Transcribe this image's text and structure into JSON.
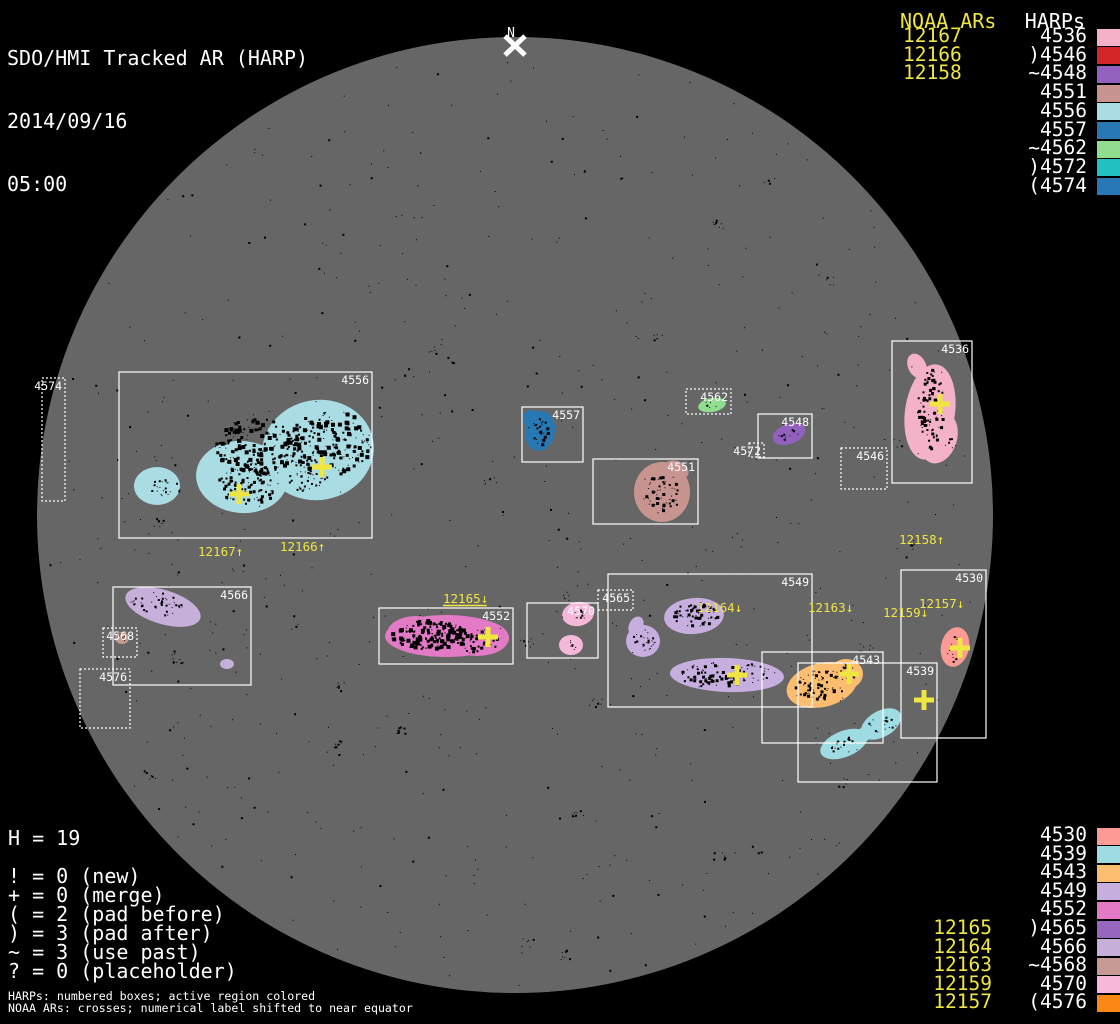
{
  "header": {
    "title": "SDO/HMI Tracked AR (HARP)",
    "date": "2014/09/16",
    "time": "05:00"
  },
  "north_marker": {
    "label": "N"
  },
  "colors": {
    "background": "#000000",
    "disk": "#666666",
    "accent_yellow": "#f0e641",
    "box_stroke": "#ffffff"
  },
  "top_right": {
    "noaa_header": "NOAA ARs",
    "noaa_numbers": [
      "12167",
      "12166",
      "12158"
    ],
    "harps_header": "HARPs",
    "harps": [
      {
        "prefix": "",
        "label": "4536",
        "color": "#f4b2c8"
      },
      {
        "prefix": ")",
        "label": "4546",
        "color": "#d32426"
      },
      {
        "prefix": "~",
        "label": "4548",
        "color": "#9161bd"
      },
      {
        "prefix": "",
        "label": "4551",
        "color": "#c79490"
      },
      {
        "prefix": "",
        "label": "4556",
        "color": "#aadce4"
      },
      {
        "prefix": "",
        "label": "4557",
        "color": "#2878b4"
      },
      {
        "prefix": "~",
        "label": "4562",
        "color": "#90dd90"
      },
      {
        "prefix": ")",
        "label": "4572",
        "color": "#20c0c0"
      },
      {
        "prefix": "(",
        "label": "4574",
        "color": "#2878b8"
      }
    ]
  },
  "bottom_right": {
    "harps": [
      {
        "prefix": "",
        "label": "4530",
        "color": "#fc9a96",
        "noaa": ""
      },
      {
        "prefix": "",
        "label": "4539",
        "color": "#9edbe2",
        "noaa": ""
      },
      {
        "prefix": "",
        "label": "4543",
        "color": "#fdbd70",
        "noaa": ""
      },
      {
        "prefix": "",
        "label": "4549",
        "color": "#c6aede",
        "noaa": ""
      },
      {
        "prefix": "",
        "label": "4552",
        "color": "#e27ac6",
        "noaa": ""
      },
      {
        "prefix": ")",
        "label": "4565",
        "color": "#9767bf",
        "noaa": "12165"
      },
      {
        "prefix": "",
        "label": "4566",
        "color": "#c6b0da",
        "noaa": "12164"
      },
      {
        "prefix": "~",
        "label": "4568",
        "color": "#c49a92",
        "noaa": "12163"
      },
      {
        "prefix": "",
        "label": "4570",
        "color": "#f5b8d8",
        "noaa": "12159"
      },
      {
        "prefix": "(",
        "label": "4576",
        "color": "#fb8714",
        "noaa": "12157"
      }
    ]
  },
  "legend": {
    "h_count": "H = 19",
    "lines": [
      "! = 0 (new)",
      "+ = 0 (merge)",
      "( = 2 (pad before)",
      ") = 3 (pad after)",
      "~ = 3 (use past)",
      "? = 0 (placeholder)"
    ]
  },
  "footnotes": [
    "HARPs: numbered boxes; active region colored",
    "NOAA ARs: crosses; numerical label shifted to near equator"
  ],
  "chart_data": {
    "type": "map",
    "description": "Solar disk magnetogram with HARP bounding boxes (white), colored active-region patches, and yellow NOAA AR crosses with labels shifted toward the equator",
    "disk": {
      "cx": 515,
      "cy": 515,
      "r": 478,
      "color": "#666666"
    },
    "regions": [
      {
        "harp": "4556",
        "box": [
          119,
          372,
          253,
          166
        ],
        "border": "solid",
        "color": "#aadce4"
      },
      {
        "harp": "4557",
        "box": [
          522,
          407,
          61,
          55
        ],
        "border": "solid",
        "color": "#2878b4"
      },
      {
        "harp": "4551",
        "box": [
          593,
          459,
          105,
          65
        ],
        "border": "solid",
        "color": "#c79490"
      },
      {
        "harp": "4548",
        "box": [
          758,
          414,
          54,
          44
        ],
        "border": "solid",
        "color": "#9161bd"
      },
      {
        "harp": "4562",
        "box": [
          686,
          389,
          45,
          25
        ],
        "border": "dotted",
        "color": "#90dd90"
      },
      {
        "harp": "4572",
        "box": [
          749,
          443,
          15,
          14
        ],
        "border": "dotted",
        "color": null
      },
      {
        "harp": "4536",
        "box": [
          892,
          341,
          80,
          142
        ],
        "border": "solid",
        "color": "#f4b2c8"
      },
      {
        "harp": "4546",
        "box": [
          841,
          448,
          46,
          41
        ],
        "border": "dotted",
        "color": null
      },
      {
        "harp": "4574",
        "box": [
          42,
          378,
          23,
          123
        ],
        "border": "dotted",
        "color": null
      },
      {
        "harp": "4566",
        "box": [
          113,
          587,
          138,
          98
        ],
        "border": "solid",
        "color": "#c6b0da"
      },
      {
        "harp": "4568",
        "box": [
          103,
          628,
          34,
          29
        ],
        "border": "dotted",
        "color": "#c49a92"
      },
      {
        "harp": "4576",
        "box": [
          80,
          669,
          50,
          59
        ],
        "border": "dotted",
        "color": null
      },
      {
        "harp": "4552",
        "box": [
          379,
          608,
          134,
          56
        ],
        "border": "solid",
        "color": "#e27ac6"
      },
      {
        "harp": "4570",
        "box": [
          527,
          603,
          71,
          55
        ],
        "border": "solid",
        "color": "#f5b8d8"
      },
      {
        "harp": "4565",
        "box": [
          598,
          590,
          35,
          20
        ],
        "border": "dotted",
        "color": "#9767bf"
      },
      {
        "harp": "4549",
        "box": [
          608,
          574,
          204,
          133
        ],
        "border": "solid",
        "color": "#c6aede"
      },
      {
        "harp": "4543",
        "box": [
          762,
          652,
          121,
          91
        ],
        "border": "solid",
        "color": "#fdbd70"
      },
      {
        "harp": "4539",
        "box": [
          798,
          663,
          139,
          119
        ],
        "border": "solid",
        "color": "#9edbe2"
      },
      {
        "harp": "4530",
        "box": [
          901,
          570,
          85,
          168
        ],
        "border": "solid",
        "color": "#fc9a96"
      }
    ],
    "noaa_labels": [
      {
        "noaa": "12167",
        "arrow": "↑",
        "x": 198,
        "y": 556,
        "underline": false
      },
      {
        "noaa": "12166",
        "arrow": "↑",
        "x": 280,
        "y": 551,
        "underline": false
      },
      {
        "noaa": "12158",
        "arrow": "↑",
        "x": 899,
        "y": 544,
        "underline": false
      },
      {
        "noaa": "12165",
        "arrow": "↓",
        "x": 443,
        "y": 603,
        "underline": true
      },
      {
        "noaa": "12164",
        "arrow": "↓",
        "x": 697,
        "y": 612,
        "underline": false
      },
      {
        "noaa": "12163",
        "arrow": "↓",
        "x": 808,
        "y": 612,
        "underline": false
      },
      {
        "noaa": "12159",
        "arrow": "↓",
        "x": 883,
        "y": 617,
        "underline": false
      },
      {
        "noaa": "12157",
        "arrow": "↓",
        "x": 919,
        "y": 608,
        "underline": false
      }
    ],
    "crosses": [
      {
        "noaa": "12167",
        "x": 239,
        "y": 494
      },
      {
        "noaa": "12166",
        "x": 322,
        "y": 467
      },
      {
        "noaa": "12158",
        "x": 940,
        "y": 404
      },
      {
        "noaa": "12165",
        "x": 488,
        "y": 637
      },
      {
        "noaa": "12164",
        "x": 737,
        "y": 675
      },
      {
        "noaa": "12163",
        "x": 849,
        "y": 674
      },
      {
        "noaa": "12159",
        "x": 924,
        "y": 700
      },
      {
        "noaa": "12157",
        "x": 960,
        "y": 648
      }
    ]
  }
}
